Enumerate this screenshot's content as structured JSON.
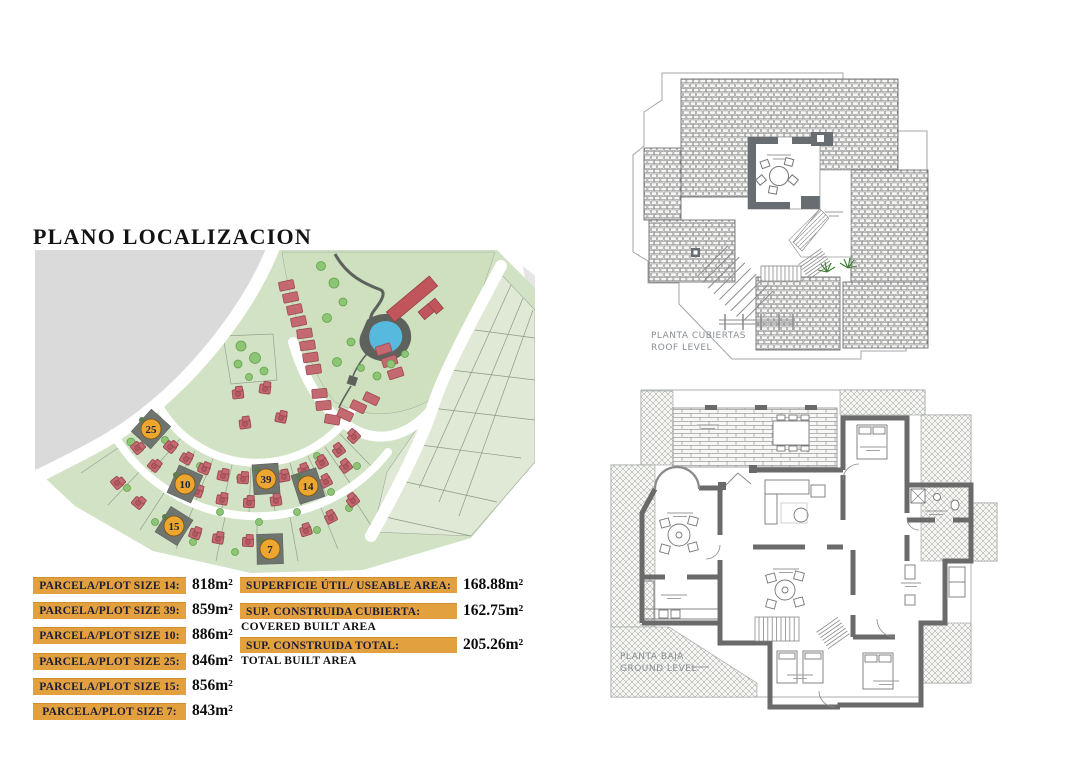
{
  "document": {
    "title": "PLANO LOCALIZACION"
  },
  "site_map": {
    "badges": [
      "25",
      "10",
      "39",
      "14",
      "15",
      "7"
    ]
  },
  "plot_table": {
    "rows": [
      {
        "label": "PARCELA/PLOT SIZE 14:",
        "value": "818m²"
      },
      {
        "label": "PARCELA/PLOT SIZE 39:",
        "value": "859m²"
      },
      {
        "label": "PARCELA/PLOT SIZE 10:",
        "value": "886m²"
      },
      {
        "label": "PARCELA/PLOT SIZE 25:",
        "value": "846m²"
      },
      {
        "label": "PARCELA/PLOT SIZE 15:",
        "value": "856m²"
      },
      {
        "label": "PARCELA/PLOT SIZE 7:",
        "value": "843m²"
      }
    ]
  },
  "area_table": {
    "rows": [
      {
        "label": "SUPERFICIE ÚTIL/ USEABLE AREA:",
        "value": "168.88m²",
        "sublabel": ""
      },
      {
        "label": "SUP. CONSTRUIDA CUBIERTA:",
        "value": "162.75m²",
        "sublabel": "COVERED BUILT AREA"
      },
      {
        "label": "SUP. CONSTRUIDA TOTAL:",
        "value": "205.26m²",
        "sublabel": "TOTAL BUILT AREA"
      }
    ]
  },
  "roof_plan": {
    "label_line1": "PLANTA CUBIERTAS",
    "label_line2": "ROOF LEVEL"
  },
  "ground_plan": {
    "label_line1": "PLANTA BAJA",
    "label_line2": "GROUND LEVEL"
  },
  "colors": {
    "accent_orange": "#E2A13E",
    "map_green": "#D2E2C4",
    "pool_blue": "#58B9DE",
    "house_red": "#C4696F",
    "highlight_gray": "#6F746F"
  }
}
